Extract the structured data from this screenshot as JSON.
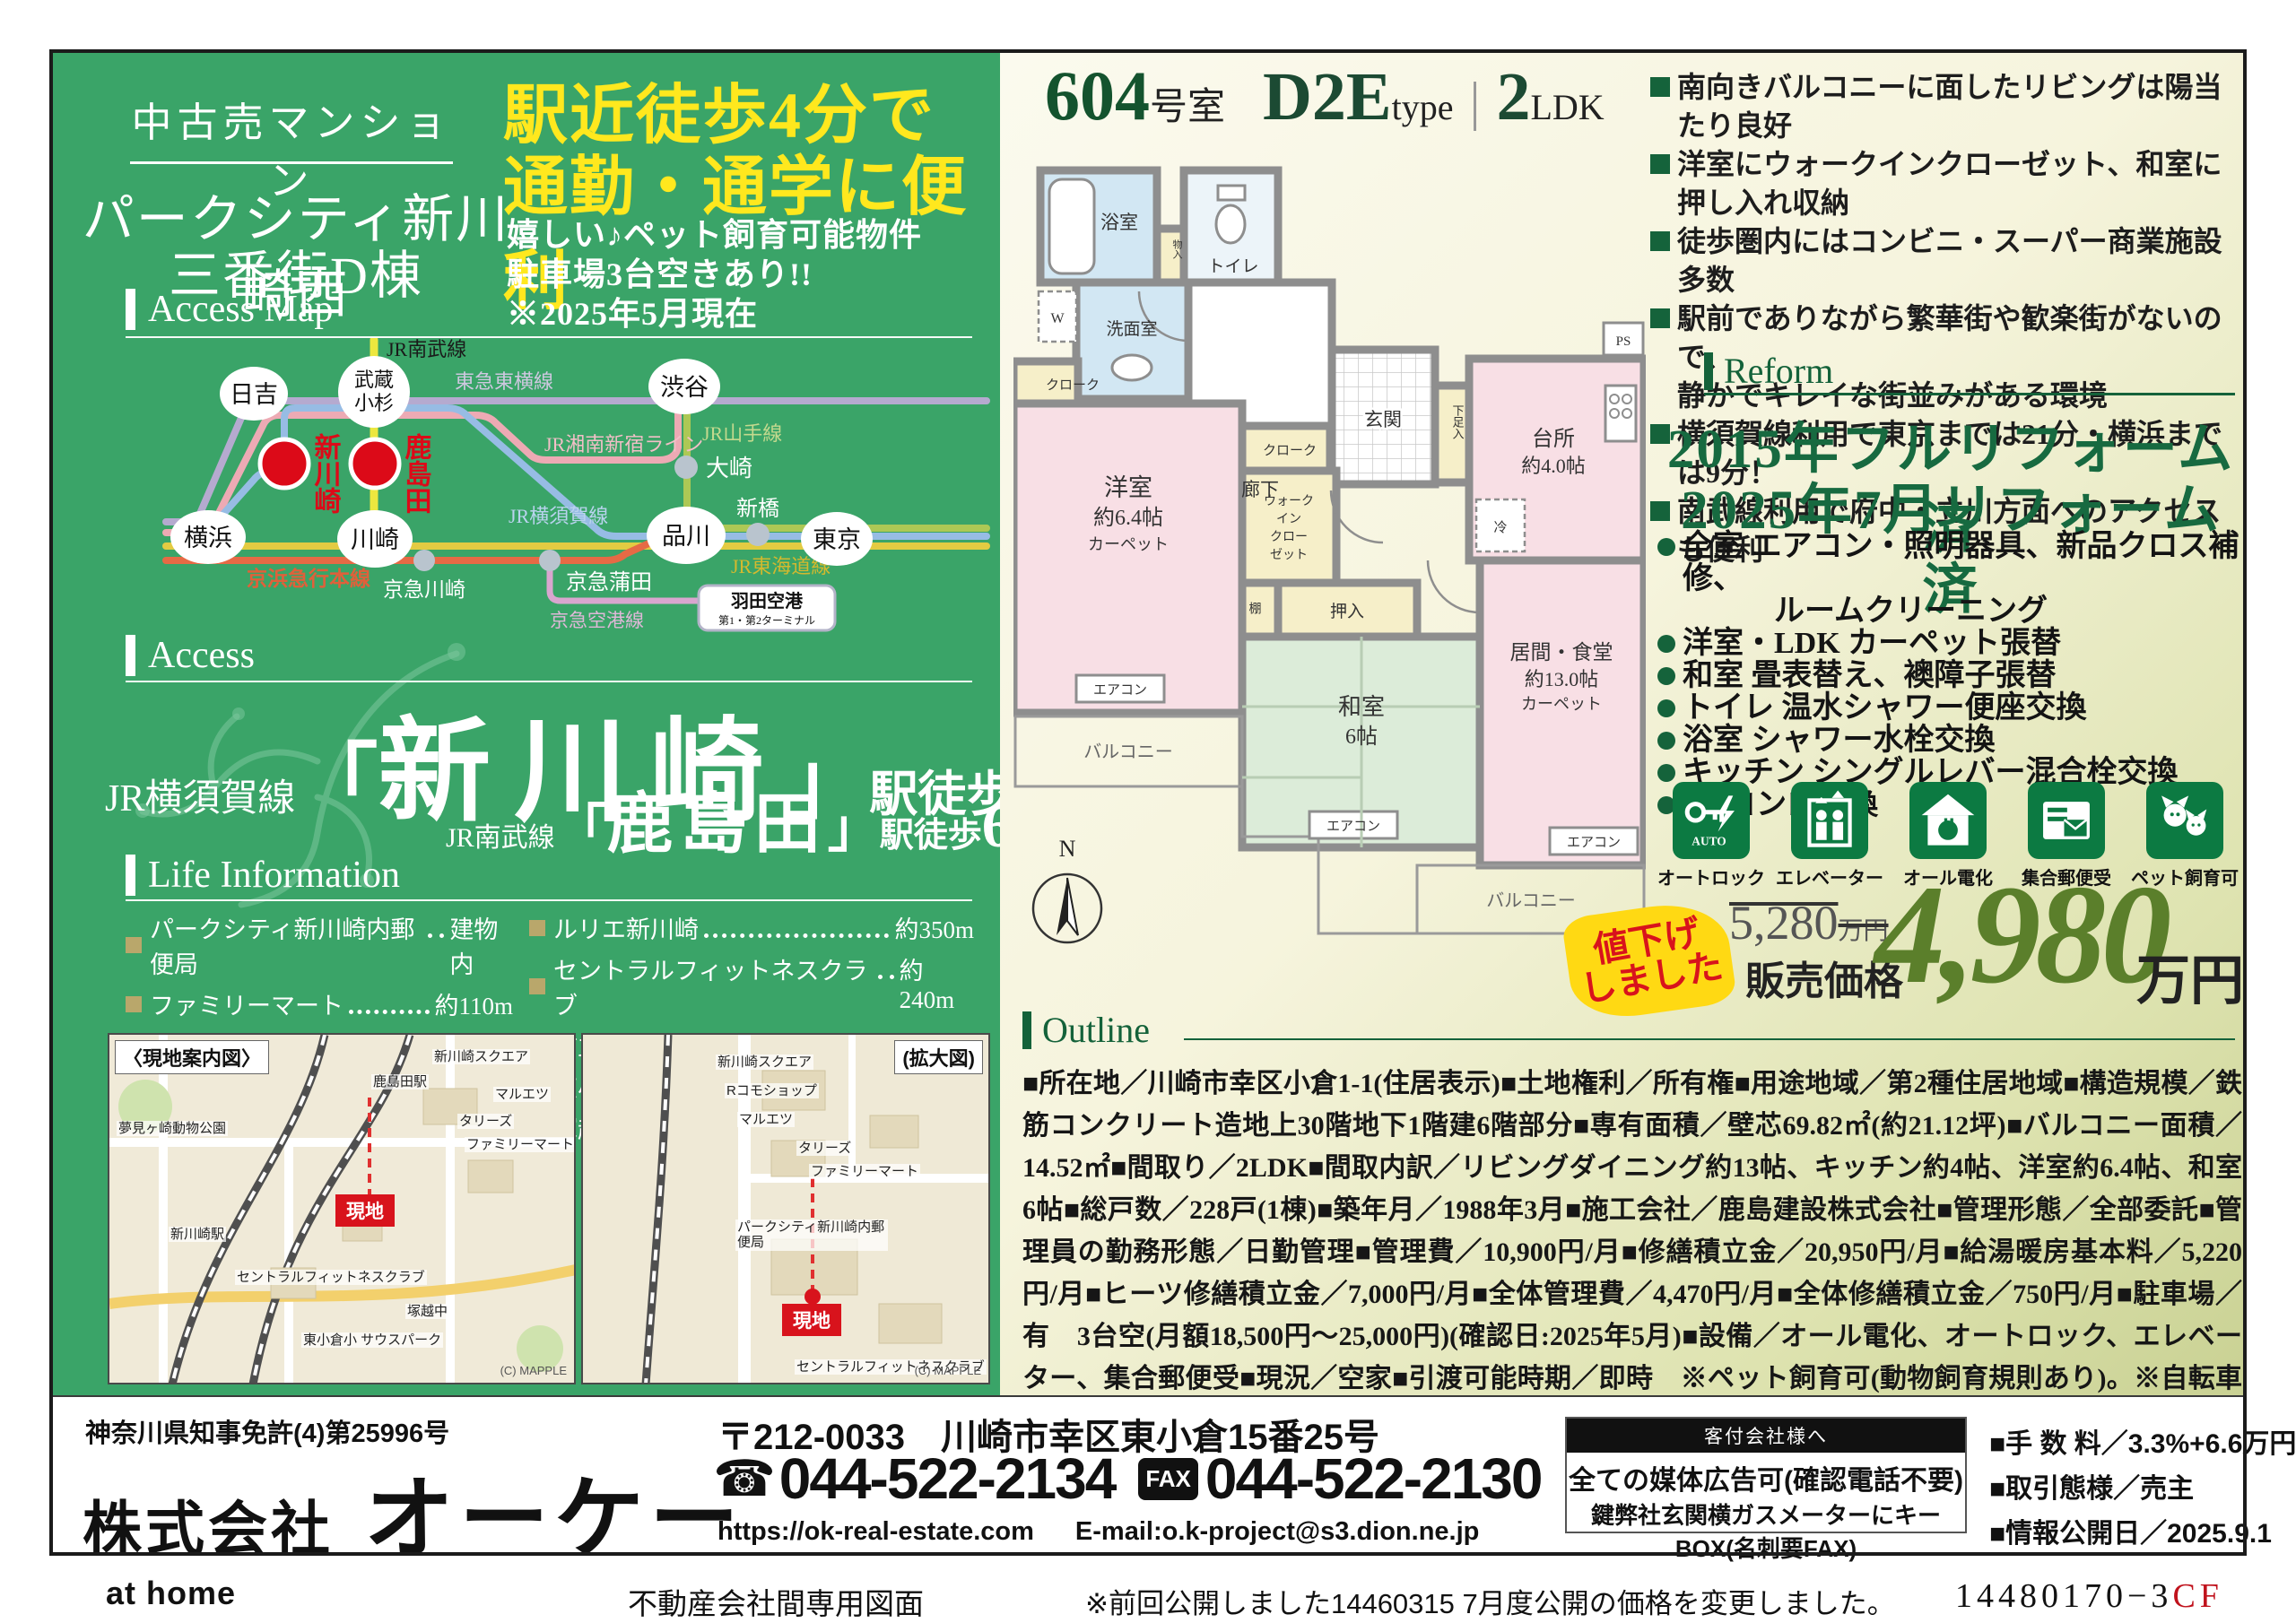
{
  "colors": {
    "panel_green": "#3aa468",
    "accent_dark_green": "#14623a",
    "catch_yellow": "#ffe81e",
    "price_green": "#5b7f2b",
    "station_red": "#dc0a18",
    "sticker_yellow": "#ffd913"
  },
  "header": {
    "category": "中古売マンション",
    "building1": "パークシティ新川崎西",
    "building2": "三番街D棟",
    "catch1": "駅近徒歩4分で",
    "catch2": "通勤・通学に便利",
    "sub1": "嬉しい♪ペット飼育可能物件",
    "sub2": "駐車場3台空きあり!!",
    "sub3": "※2025年5月現在"
  },
  "sections": {
    "access_map": "Access Map",
    "access": "Access",
    "life": "Life Information",
    "reform": "Reform",
    "outline": "Outline"
  },
  "route": {
    "lines": {
      "nambu": "JR南武線",
      "toyoko": "東急東横線",
      "shonan": "JR湘南新宿ライン",
      "yamanote": "JR山手線",
      "yokosuka": "JR横須賀線",
      "tokaido": "JR東海道線",
      "keikyu": "京浜急行本線",
      "airport": "京急空港線"
    },
    "stations": {
      "hiyoshi": "日吉",
      "musashi1": "武蔵",
      "musashi2": "小杉",
      "shibuya": "渋谷",
      "shinkawasaki": "新川崎",
      "kashimada": "鹿島田",
      "yokohama": "横浜",
      "kawasaki": "川崎",
      "osaki": "大崎",
      "shinagawa": "品川",
      "shimbashi": "新橋",
      "tokyo": "東京",
      "keikyu_kawasaki": "京急川崎",
      "keikyu_kamata": "京急蒲田",
      "haneda1": "羽田空港",
      "haneda2": "第1・第2ターミナル"
    }
  },
  "access": {
    "bracket_open": "「",
    "bracket_close": "」",
    "r1_line": "JR横須賀線",
    "r1_st": "新川崎",
    "r1_walk": "駅徒歩",
    "r1_min": "4",
    "r1_unit": "分",
    "r2_line": "JR南武線",
    "r2_st": "鹿島田",
    "r2_walk": "駅徒歩",
    "r2_min": "6",
    "r2_unit": "分"
  },
  "life": {
    "left": [
      {
        "name": "パークシティ新川崎内郵便局",
        "dist": "建物内"
      },
      {
        "name": "ファミリーマート",
        "dist": "約110m"
      },
      {
        "name": "タリーズ",
        "dist": "約110m"
      },
      {
        "name": "マルエツ",
        "dist": "約400m"
      },
      {
        "name": "りそな銀行",
        "dist": "約500m"
      }
    ],
    "right": [
      {
        "name": "ルリエ新川崎",
        "dist": "約350m"
      },
      {
        "name": "セントラルフィットネスクラブ",
        "dist": "約240m"
      },
      {
        "name": "市立図書館分館",
        "dist": "約1,300m"
      },
      {
        "name": "東小倉小学校",
        "dist": "約275m"
      },
      {
        "name": "塚越中学校",
        "dist": "約750m"
      }
    ]
  },
  "maps": {
    "left_title": "〈現地案内図〉",
    "right_title": "(拡大図)",
    "site": "現地",
    "credit": "(C) MAPPLE",
    "left_labels": [
      "鹿島田駅",
      "新川崎スクエア",
      "マルエツ",
      "タリーズ",
      "ファミリーマート",
      "新川崎駅",
      "セントラルフィットネスクラブ",
      "東小倉小 サウスパーク",
      "塚越中",
      "夢見ヶ崎動物公園"
    ],
    "right_labels": [
      "新川崎スクエア",
      "Rコモショップ",
      "マルエツ",
      "タリーズ",
      "ファミリーマート",
      "パークシティ新川崎内郵便局",
      "セントラルフィットネスクラブ"
    ]
  },
  "unit": {
    "room": "604",
    "room_suffix": "号室",
    "type_big": "D2E",
    "type_small": "type",
    "divider": "|",
    "ldk_num": "2",
    "ldk_suffix": "LDK"
  },
  "features": [
    {
      "text": "南向きバルコニーに面したリビングは陽当たり良好"
    },
    {
      "text": "洋室にウォークインクローゼット、和室に押し入れ収納"
    },
    {
      "text": "徒歩圏内にはコンビニ・スーパー商業施設多数"
    },
    {
      "text": "駅前でありながら繁華街や歓楽街がないので、"
    },
    {
      "text": "静かでキレイな街並みがある環境"
    },
    {
      "text": "横須賀線利用で東京までは21分・横浜までは9分！"
    },
    {
      "text": "南武線利用で府中・立川方面へのアクセスも便利"
    }
  ],
  "reform": {
    "title1": "2015年フルリフォーム済",
    "title2": "2025年7月リフォーム済",
    "items": [
      "全室 エアコン・照明器具、新品クロス補修、",
      "ルームクリーニング",
      "洋室・LDK カーペット張替",
      "和室 畳表替え、襖障子張替",
      "トイレ 温水シャワー便座交換",
      "浴室 シャワー水栓交換",
      "キッチン シングルレバー混合栓交換",
      "IH コンロ交換"
    ]
  },
  "badges": [
    {
      "label": "オートロック"
    },
    {
      "label": "エレベーター"
    },
    {
      "label": "オール電化"
    },
    {
      "label": "集合郵便受"
    },
    {
      "label": "ペット飼育可"
    }
  ],
  "price": {
    "sticker1": "値下げ",
    "sticker2": "しました",
    "old": "5,280",
    "old_unit": "万円",
    "label": "販売価格",
    "value": "4,980",
    "unit": "万円"
  },
  "outline": {
    "text": "■所在地／川崎市幸区小倉1-1(住居表示)■土地権利／所有権■用途地域／第2種住居地域■構造規模／鉄筋コンクリート造地上30階地下1階建6階部分■専有面積／壁芯69.82㎡(約21.12坪)■バルコニー面積／14.52㎡■間取り／2LDK■間取内訳／リビングダイニング約13帖、キッチン約4帖、洋室約6.4帖、和室6帖■総戸数／228戸(1棟)■築年月／1988年3月■施工会社／鹿島建設株式会社■管理形態／全部委託■管理員の勤務形態／日勤管理■管理費／10,900円/月■修繕積立金／20,950円/月■給湯暖房基本料／5,220円/月■ヒーツ修繕積立金／7,000円/月■全体管理費／4,470円/月■全体修繕積立金／750円/月■駐車場／有　3台空(月額18,500円〜25,000円)(確認日:2025年5月)■設備／オール電化、オートロック、エレベーター、集合郵便受■現況／空家■引渡可能時期／即時　※ペット飼育可(動物飼育規則あり)。※自転車置場有。",
    "note": "※形状等が現況と異なる場合は現況優先となることをご了承願います。"
  },
  "plan": {
    "bath": "浴室",
    "toilet": "トイレ",
    "mono": "物入",
    "wash": "洗面室",
    "w": "W",
    "cloak": "クローク",
    "cloak2": "クローク",
    "hall": "廊下",
    "entrance": "玄関",
    "shoe": "下足入",
    "kitchen1": "台所",
    "kitchen2": "約4.0帖",
    "fridge": "冷",
    "west1": "洋室",
    "west2": "約6.4帖",
    "west3": "カーペット",
    "wic1": "ウォーク",
    "wic2": "イン",
    "wic3": "クロー",
    "wic4": "ゼット",
    "shelf": "棚",
    "oshiire": "押入",
    "tatami1": "和室",
    "tatami2": "6帖",
    "living1": "居間・食堂",
    "living2": "約13.0帖",
    "living3": "カーペット",
    "balcony": "バルコニー",
    "balcony2": "バルコニー",
    "aircon": "エアコン",
    "ps": "PS",
    "north": "N"
  },
  "company": {
    "license": "神奈川県知事免許(4)第25996号",
    "name_prefix": "株式会社",
    "name": "オーケー",
    "postal": "〒212-0033",
    "address": "川崎市幸区東小倉15番25号",
    "tel_icon": "☎",
    "tel": "044-522-2134",
    "fax_label": "FAX",
    "fax": "044-522-2130",
    "url": "https://ok-real-estate.com",
    "email": "E-mail:o.k-project@s3.dion.ne.jp",
    "box_header": "客付会社様へ",
    "box_line1": "全ての媒体広告可(確認電話不要)",
    "box_line2": "鍵弊社玄関横ガスメーターにキーBOX(名刺要FAX)",
    "fee": "■手 数 料／3.3%+6.6万円",
    "deal": "■取引態様／売主",
    "publish": "■情報公開日／2025.9.1"
  },
  "footer": {
    "athome": "at home",
    "doc_type": "不動産会社間専用図面",
    "note": "※前回公開しました14460315 7月度公開の価格を変更しました。",
    "code": "14480170−3",
    "code_suffix": "CF"
  }
}
